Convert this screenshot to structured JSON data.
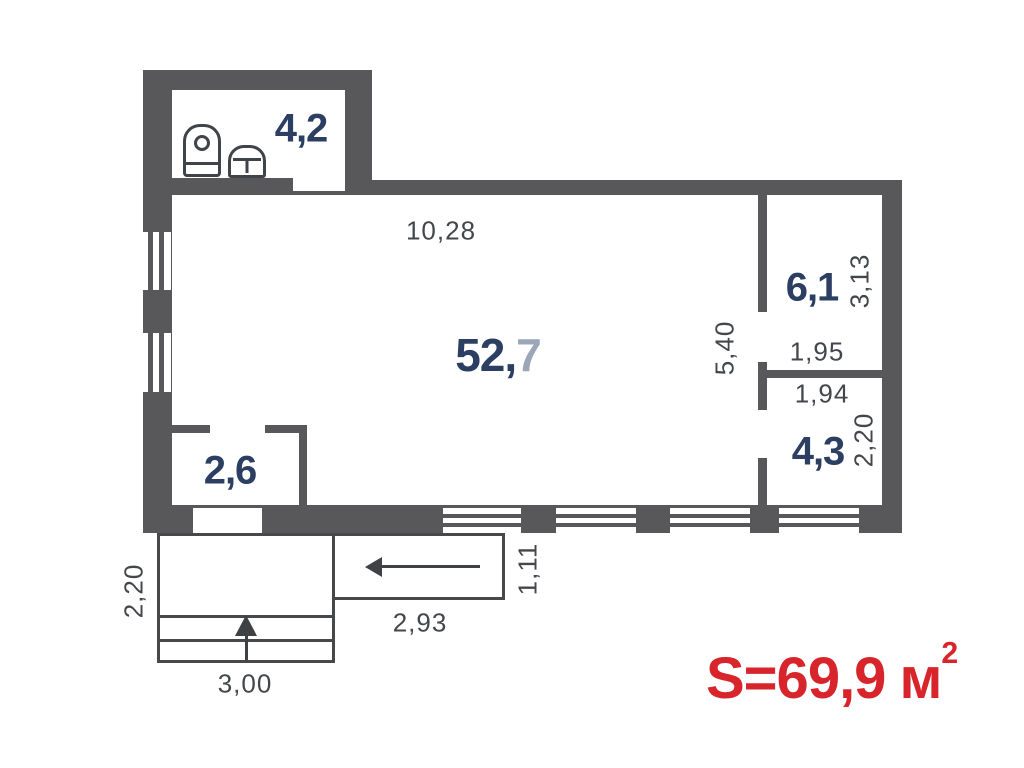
{
  "type": "floor-plan",
  "rooms": {
    "bathroom": {
      "area": "4,2"
    },
    "living": {
      "area_whole": "52,",
      "area_frac": "7"
    },
    "storage_top": {
      "area": "6,1"
    },
    "storage_bottom": {
      "area": "4,3"
    },
    "closet": {
      "area": "2,6"
    }
  },
  "dimensions": {
    "living_width": "10,28",
    "living_height": "5,40",
    "storage_top_height": "3,13",
    "storage_top_width": "1,95",
    "storage_bottom_width": "1,94",
    "storage_bottom_height": "2,20",
    "porch_height": "2,20",
    "porch_width": "3,00",
    "walkway_width": "2,93",
    "walkway_height": "1,11"
  },
  "total_area": {
    "label": "S=69,9",
    "unit": "м",
    "exponent": "2"
  },
  "icons": {
    "toilet": "toilet-icon",
    "sink": "sink-icon",
    "stairs_direction": "arrow-up-icon",
    "entrance_direction": "arrow-left-icon"
  },
  "colors": {
    "wall": "#58585a",
    "room_label": "#2c3f63",
    "room_label_light": "#9ba6b9",
    "dimension_text": "#43474c",
    "total_area_text": "#d8252b",
    "outline": "#47484a"
  }
}
